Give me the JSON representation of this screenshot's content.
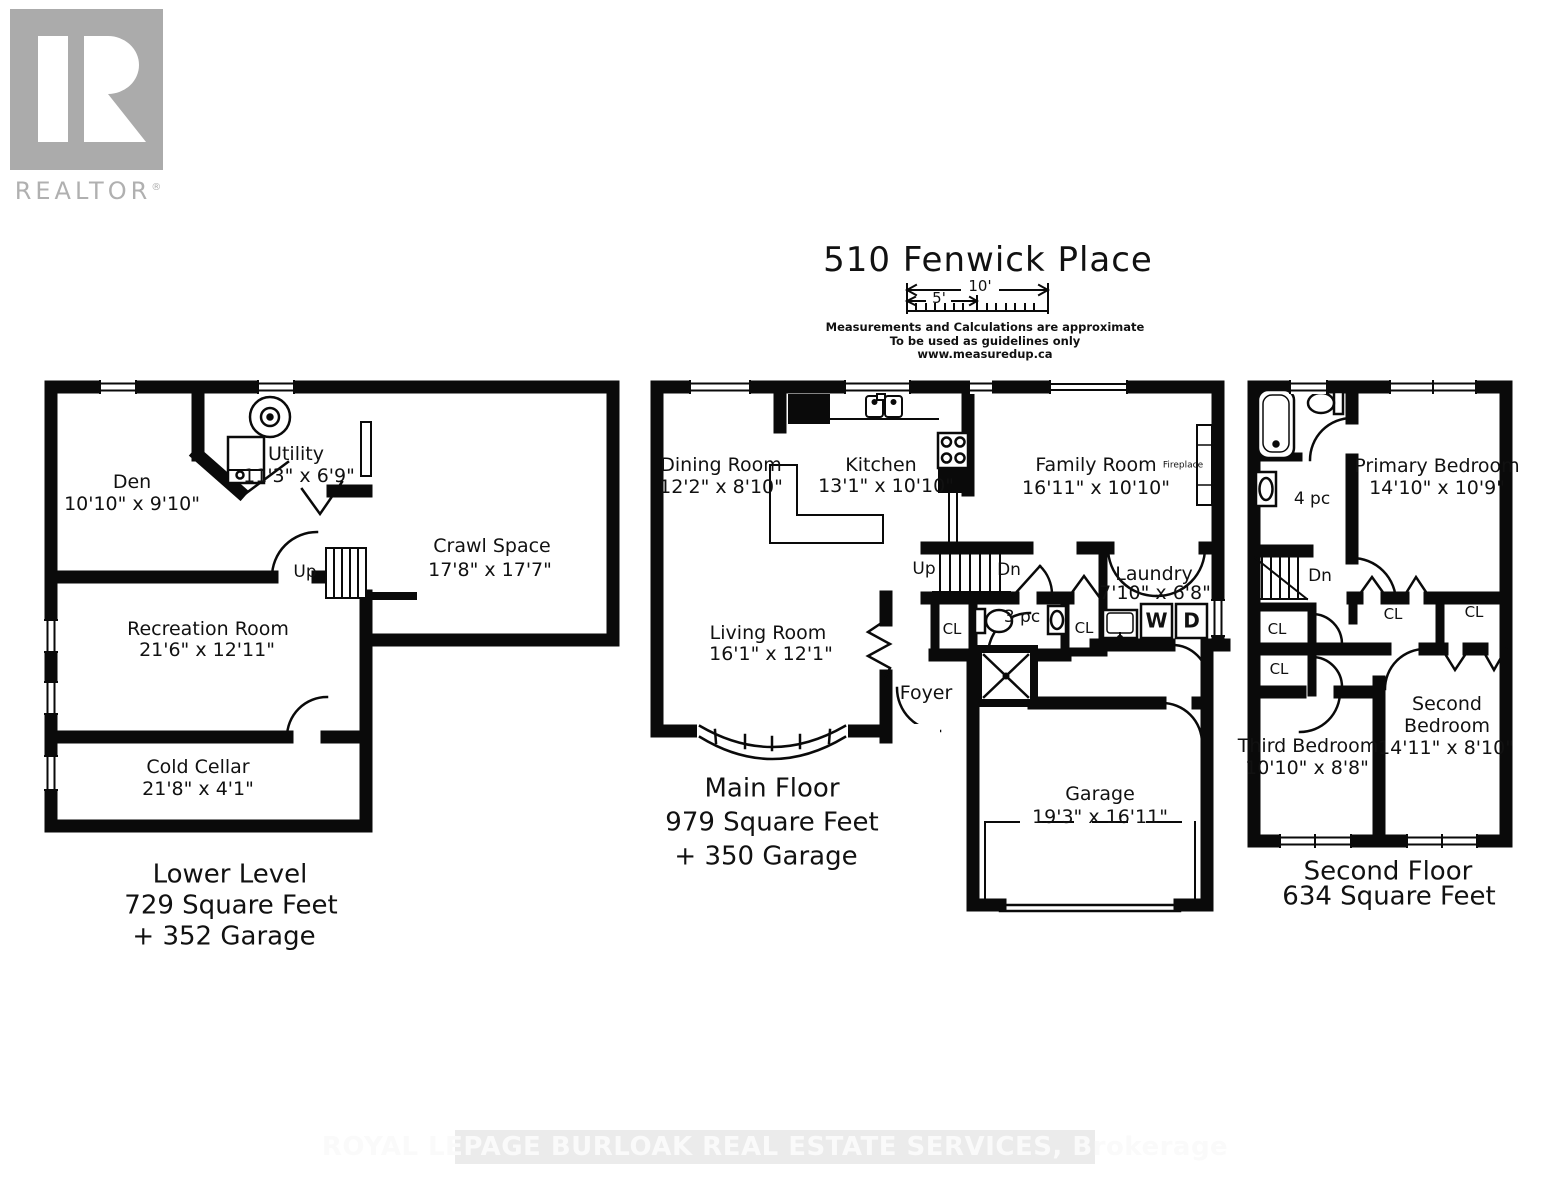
{
  "logo": {
    "brand": "REALTOR",
    "reg": "®"
  },
  "header": {
    "title": "510 Fenwick Place",
    "scale_10": "10'",
    "scale_5": "5'",
    "disclaimer1": "Measurements and Calculations are approximate",
    "disclaimer2": "To be used as guidelines only",
    "disclaimer3": "www.measuredup.ca"
  },
  "markers": {
    "up": "Up",
    "dn": "Dn",
    "closet": "CL",
    "washer": "W",
    "dryer": "D",
    "bath3": "3 pc",
    "bath4": "4 pc",
    "fireplace": "Fireplace",
    "foyer": "Foyer"
  },
  "lower": {
    "title": "Lower Level",
    "area": "729 Square Feet",
    "extra": "+ 352 Garage",
    "den_name": "Den",
    "den_dims": "10'10\" x 9'10\"",
    "utility_name": "Utility",
    "utility_dims": "11'3\" x 6'9\"",
    "crawl_name": "Crawl Space",
    "crawl_dims": "17'8\" x 17'7\"",
    "rec_name": "Recreation Room",
    "rec_dims": "21'6\" x 12'11\"",
    "cold_name": "Cold Cellar",
    "cold_dims": "21'8\" x 4'1\""
  },
  "main": {
    "title": "Main Floor",
    "area": "979 Square Feet",
    "extra": "+ 350 Garage",
    "dining_name": "Dining Room",
    "dining_dims": "12'2\" x 8'10\"",
    "kitchen_name": "Kitchen",
    "kitchen_dims": "13'1\" x 10'10\"",
    "family_name": "Family Room",
    "family_dims": "16'11\" x 10'10\"",
    "living_name": "Living Room",
    "living_dims": "16'1\" x 12'1\"",
    "laundry_name": "Laundry",
    "laundry_dims": "7'10\" x 6'8\"",
    "garage_name": "Garage",
    "garage_dims": "19'3\" x 16'11\""
  },
  "second": {
    "title": "Second Floor",
    "area": "634 Square Feet",
    "primary_name": "Primary Bedroom",
    "primary_dims": "14'10\" x 10'9\"",
    "second_name1": "Second",
    "second_name2": "Bedroom",
    "second_dims": "14'11\" x 8'10\"",
    "third_name": "Third Bedroom",
    "third_dims": "10'10\" x 8'8\""
  },
  "watermark": "ROYAL LEPAGE BURLOAK REAL ESTATE SERVICES, Brokerage"
}
